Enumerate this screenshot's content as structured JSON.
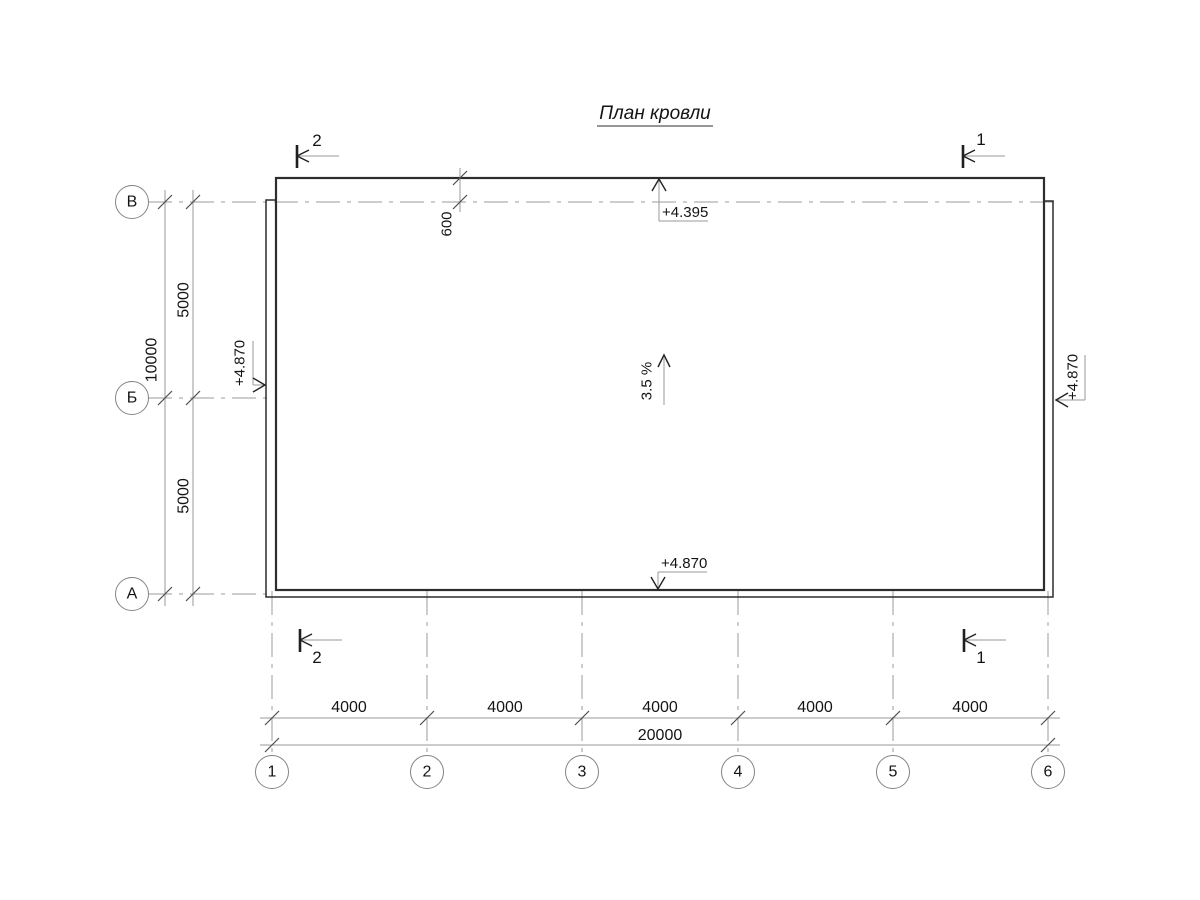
{
  "title": "План кровли",
  "axes": {
    "rows": [
      "В",
      "Б",
      "А"
    ],
    "cols": [
      "1",
      "2",
      "3",
      "4",
      "5",
      "6"
    ]
  },
  "dimensions": {
    "vertical": {
      "segments": [
        "5000",
        "5000"
      ],
      "total": "10000"
    },
    "horizontal": {
      "segments": [
        "4000",
        "4000",
        "4000",
        "4000",
        "4000"
      ],
      "total": "20000"
    },
    "overhang": "600"
  },
  "elevations": {
    "top": "+4.395",
    "bottom": "+4.870",
    "left": "+4.870",
    "right": "+4.870"
  },
  "slope": "3.5 %",
  "sections": {
    "top_left": "2",
    "top_right": "1",
    "bottom_left": "2",
    "bottom_right": "1"
  }
}
